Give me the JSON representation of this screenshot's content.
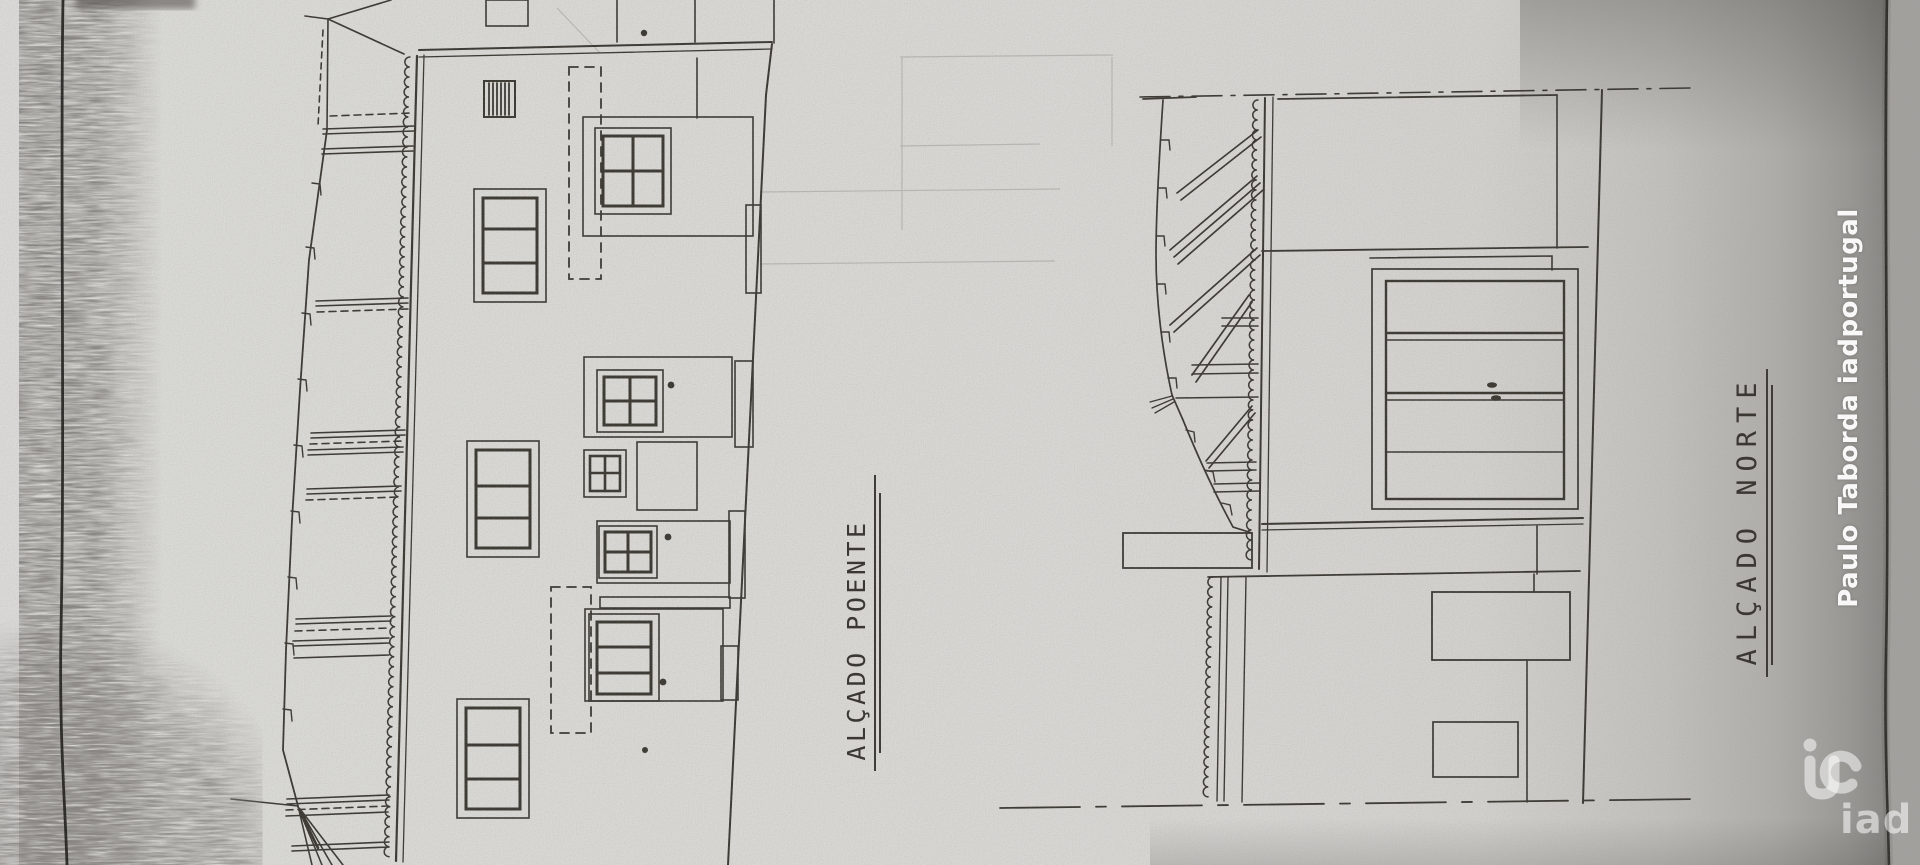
{
  "image": {
    "kind": "photo of photocopied architectural elevation drawings",
    "paper_color": "#d7d6d3",
    "ink_color": "#3a3733"
  },
  "drawings": {
    "west_elevation": {
      "label": "ALÇADO POENTE"
    },
    "north_elevation": {
      "label": "ALÇADO NORTE"
    }
  },
  "watermark": {
    "agent_name": "Paulo Taborda iadportugal",
    "brand_wordmark": "iad",
    "color": "#ffffff"
  }
}
